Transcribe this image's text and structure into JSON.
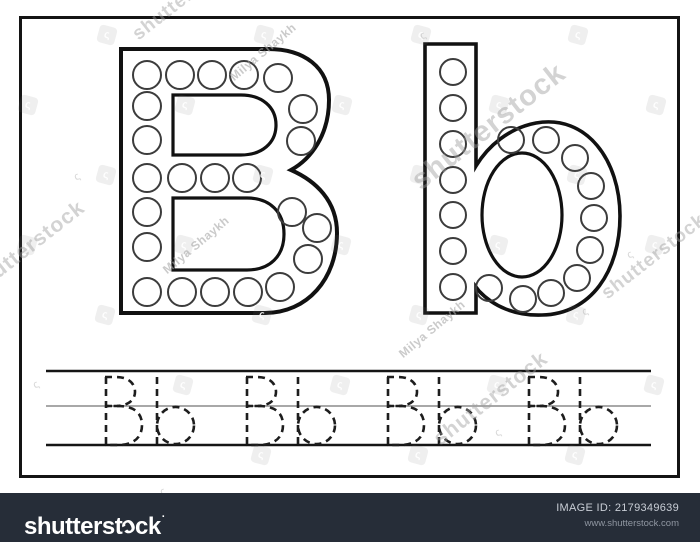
{
  "worksheet": {
    "uppercase_letter": "B",
    "lowercase_letter": "b",
    "uppercase_dots": [
      [
        147,
        75
      ],
      [
        180,
        75
      ],
      [
        212,
        75
      ],
      [
        244,
        75
      ],
      [
        278,
        78
      ],
      [
        303,
        109
      ],
      [
        301,
        141
      ],
      [
        147,
        106
      ],
      [
        147,
        140
      ],
      [
        147,
        178
      ],
      [
        182,
        178
      ],
      [
        215,
        178
      ],
      [
        247,
        178
      ],
      [
        292,
        212
      ],
      [
        317,
        228
      ],
      [
        308,
        259
      ],
      [
        280,
        287
      ],
      [
        147,
        212
      ],
      [
        147,
        247
      ],
      [
        147,
        292
      ],
      [
        182,
        292
      ],
      [
        215,
        292
      ],
      [
        248,
        292
      ]
    ],
    "uppercase_dot_radius": 14,
    "lowercase_dots": [
      [
        453,
        72
      ],
      [
        453,
        108
      ],
      [
        453,
        144
      ],
      [
        453,
        180
      ],
      [
        453,
        215
      ],
      [
        453,
        251
      ],
      [
        453,
        287
      ],
      [
        511,
        140
      ],
      [
        546,
        140
      ],
      [
        575,
        158
      ],
      [
        591,
        186
      ],
      [
        594,
        218
      ],
      [
        590,
        250
      ],
      [
        577,
        278
      ],
      [
        551,
        293
      ],
      [
        523,
        299
      ],
      [
        489,
        288
      ]
    ],
    "lowercase_dot_radius": 13,
    "tracing_pairs": [
      "Bb",
      "Bb",
      "Bb",
      "Bb"
    ]
  },
  "watermarks": {
    "brand_text": "shutterstock",
    "brand_instances": [
      {
        "x": 28,
        "y": 248,
        "size": 21,
        "rot": -38
      },
      {
        "x": 489,
        "y": 127,
        "size": 29,
        "rot": -38
      },
      {
        "x": 654,
        "y": 257,
        "size": 19,
        "rot": -38
      },
      {
        "x": 491,
        "y": 399,
        "size": 21,
        "rot": -38
      },
      {
        "x": 185,
        "y": -2,
        "size": 19,
        "rot": -38
      }
    ],
    "artist_text": "Milya Shaykh",
    "artist_instances": [
      {
        "x": 196,
        "y": 245,
        "rot": -40
      },
      {
        "x": 263,
        "y": 52,
        "rot": -40
      },
      {
        "x": 432,
        "y": 329,
        "rot": -40
      }
    ],
    "curl_glyph": "ς",
    "curl_instances": [
      [
        36,
        385
      ],
      [
        77,
        177
      ],
      [
        423,
        36
      ],
      [
        630,
        255
      ],
      [
        585,
        312
      ],
      [
        163,
        492
      ],
      [
        498,
        433
      ]
    ]
  },
  "footer": {
    "logo_prefix": "shutterst",
    "logo_curl": "ɔ",
    "logo_suffix": "ck",
    "logo_mark": "·",
    "image_id_label": "IMAGE ID:",
    "image_id": "2179349639",
    "website": "www.shutterstock.com",
    "bar_color": "#262d38"
  }
}
